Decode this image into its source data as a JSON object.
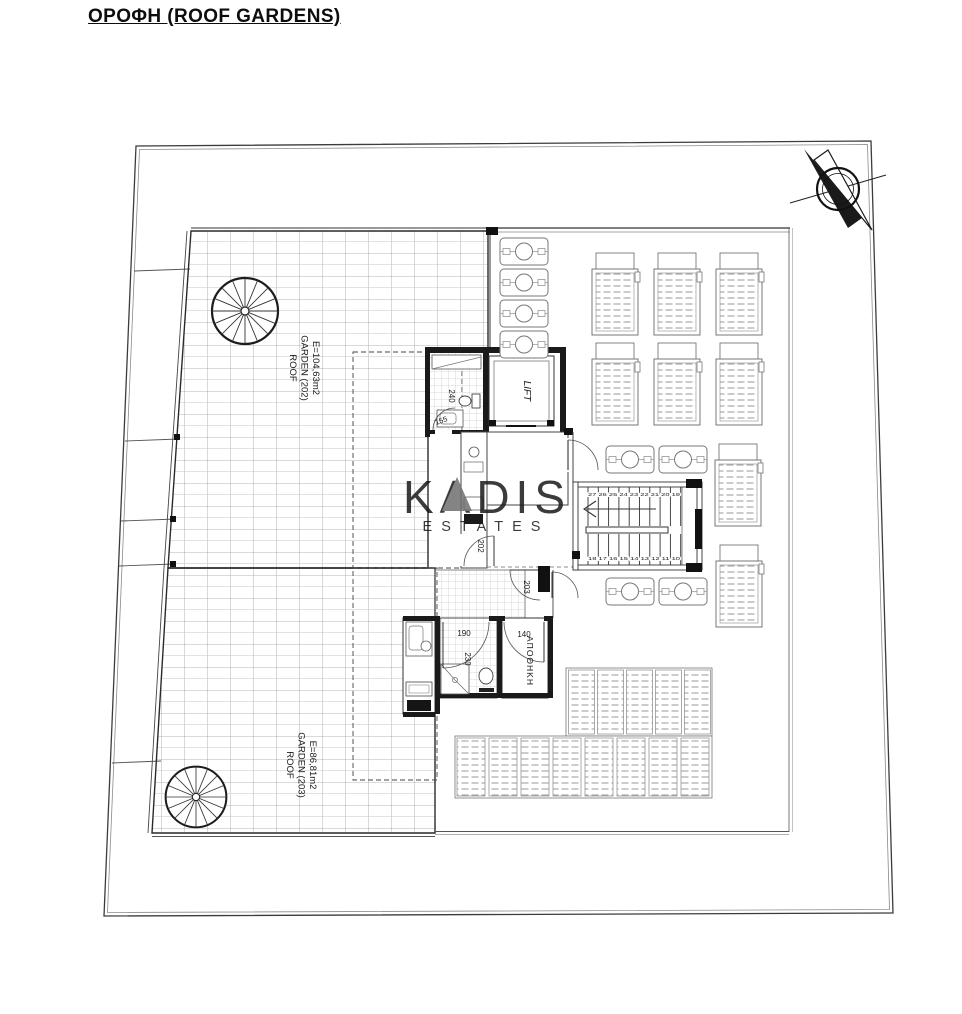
{
  "page": {
    "title": "ΟΡΟΦΗ (ROOF GARDENS)"
  },
  "watermark": {
    "name": "KADIS",
    "subtitle": "ESTATES"
  },
  "gardens": {
    "g202": {
      "line1": "ROOF",
      "line2": "GARDEN (202)",
      "line3": "E=104,63m2"
    },
    "g203": {
      "line1": "ROOF",
      "line2": "GARDEN (203)",
      "line3": "E=86,81m2"
    }
  },
  "rooms": {
    "lift": "LIFT",
    "storage": "ΑΠΟΘΗΚΗ"
  },
  "doors": {
    "garden202": "202",
    "garden203": "203"
  },
  "dimensions": {
    "bath_width": "240",
    "bath_door": "155",
    "shower_depth": "230",
    "door_middle": "190",
    "door_storage": "140"
  },
  "stairs": {
    "upper_run": "27 26 25 24 23 22 21 20 19",
    "lower_run": "18 17 16 15 14 13 12 11 10"
  },
  "colors": {
    "line": "#1a1a1a",
    "grid": "#9e9e9e",
    "watermark": "#c7c7c7"
  }
}
